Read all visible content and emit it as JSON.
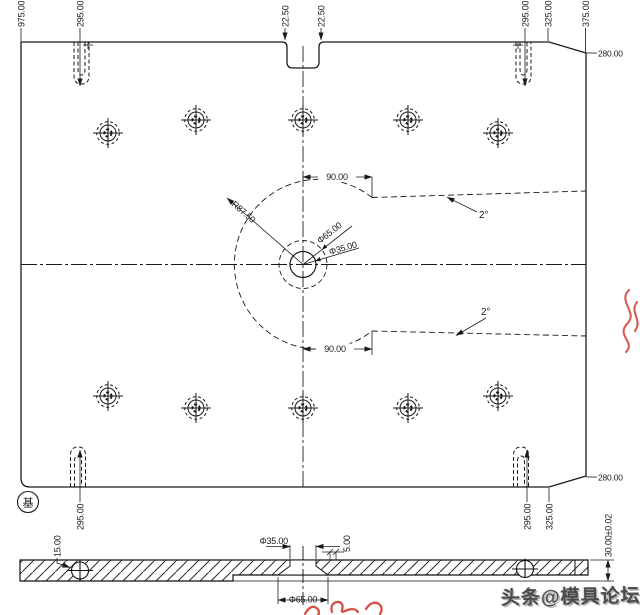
{
  "drawing": {
    "view_plan": {
      "top_ordinates": [
        "975.00",
        "295.00",
        "22.50",
        "22.50",
        "295.00",
        "325.00",
        "375.00"
      ],
      "bottom_ordinates": [
        "295.00",
        "295.00",
        "325.00"
      ],
      "corner_dim_top_right": "280.00",
      "corner_dim_bottom_right": "280.00",
      "pocket_radius": "R87.50",
      "pocket_offset_top": "90.00",
      "pocket_offset_bottom": "90.00",
      "pocket_taper_top": "2°",
      "pocket_taper_bottom": "2°",
      "center_counterbore_dia": "Φ65.00",
      "center_hole_dia": "Φ35.00",
      "datum_label": "基"
    },
    "view_section": {
      "screw_dim": "15.00",
      "hole_dia": "Φ35.00",
      "step_dim": "5.00",
      "counterbore_dia": "Φ65.00",
      "thickness": "30.00±0.02"
    }
  },
  "watermark": {
    "text": "头条@模具论坛",
    "color": "#4c4c4c",
    "accent_red": "#cc3327"
  }
}
